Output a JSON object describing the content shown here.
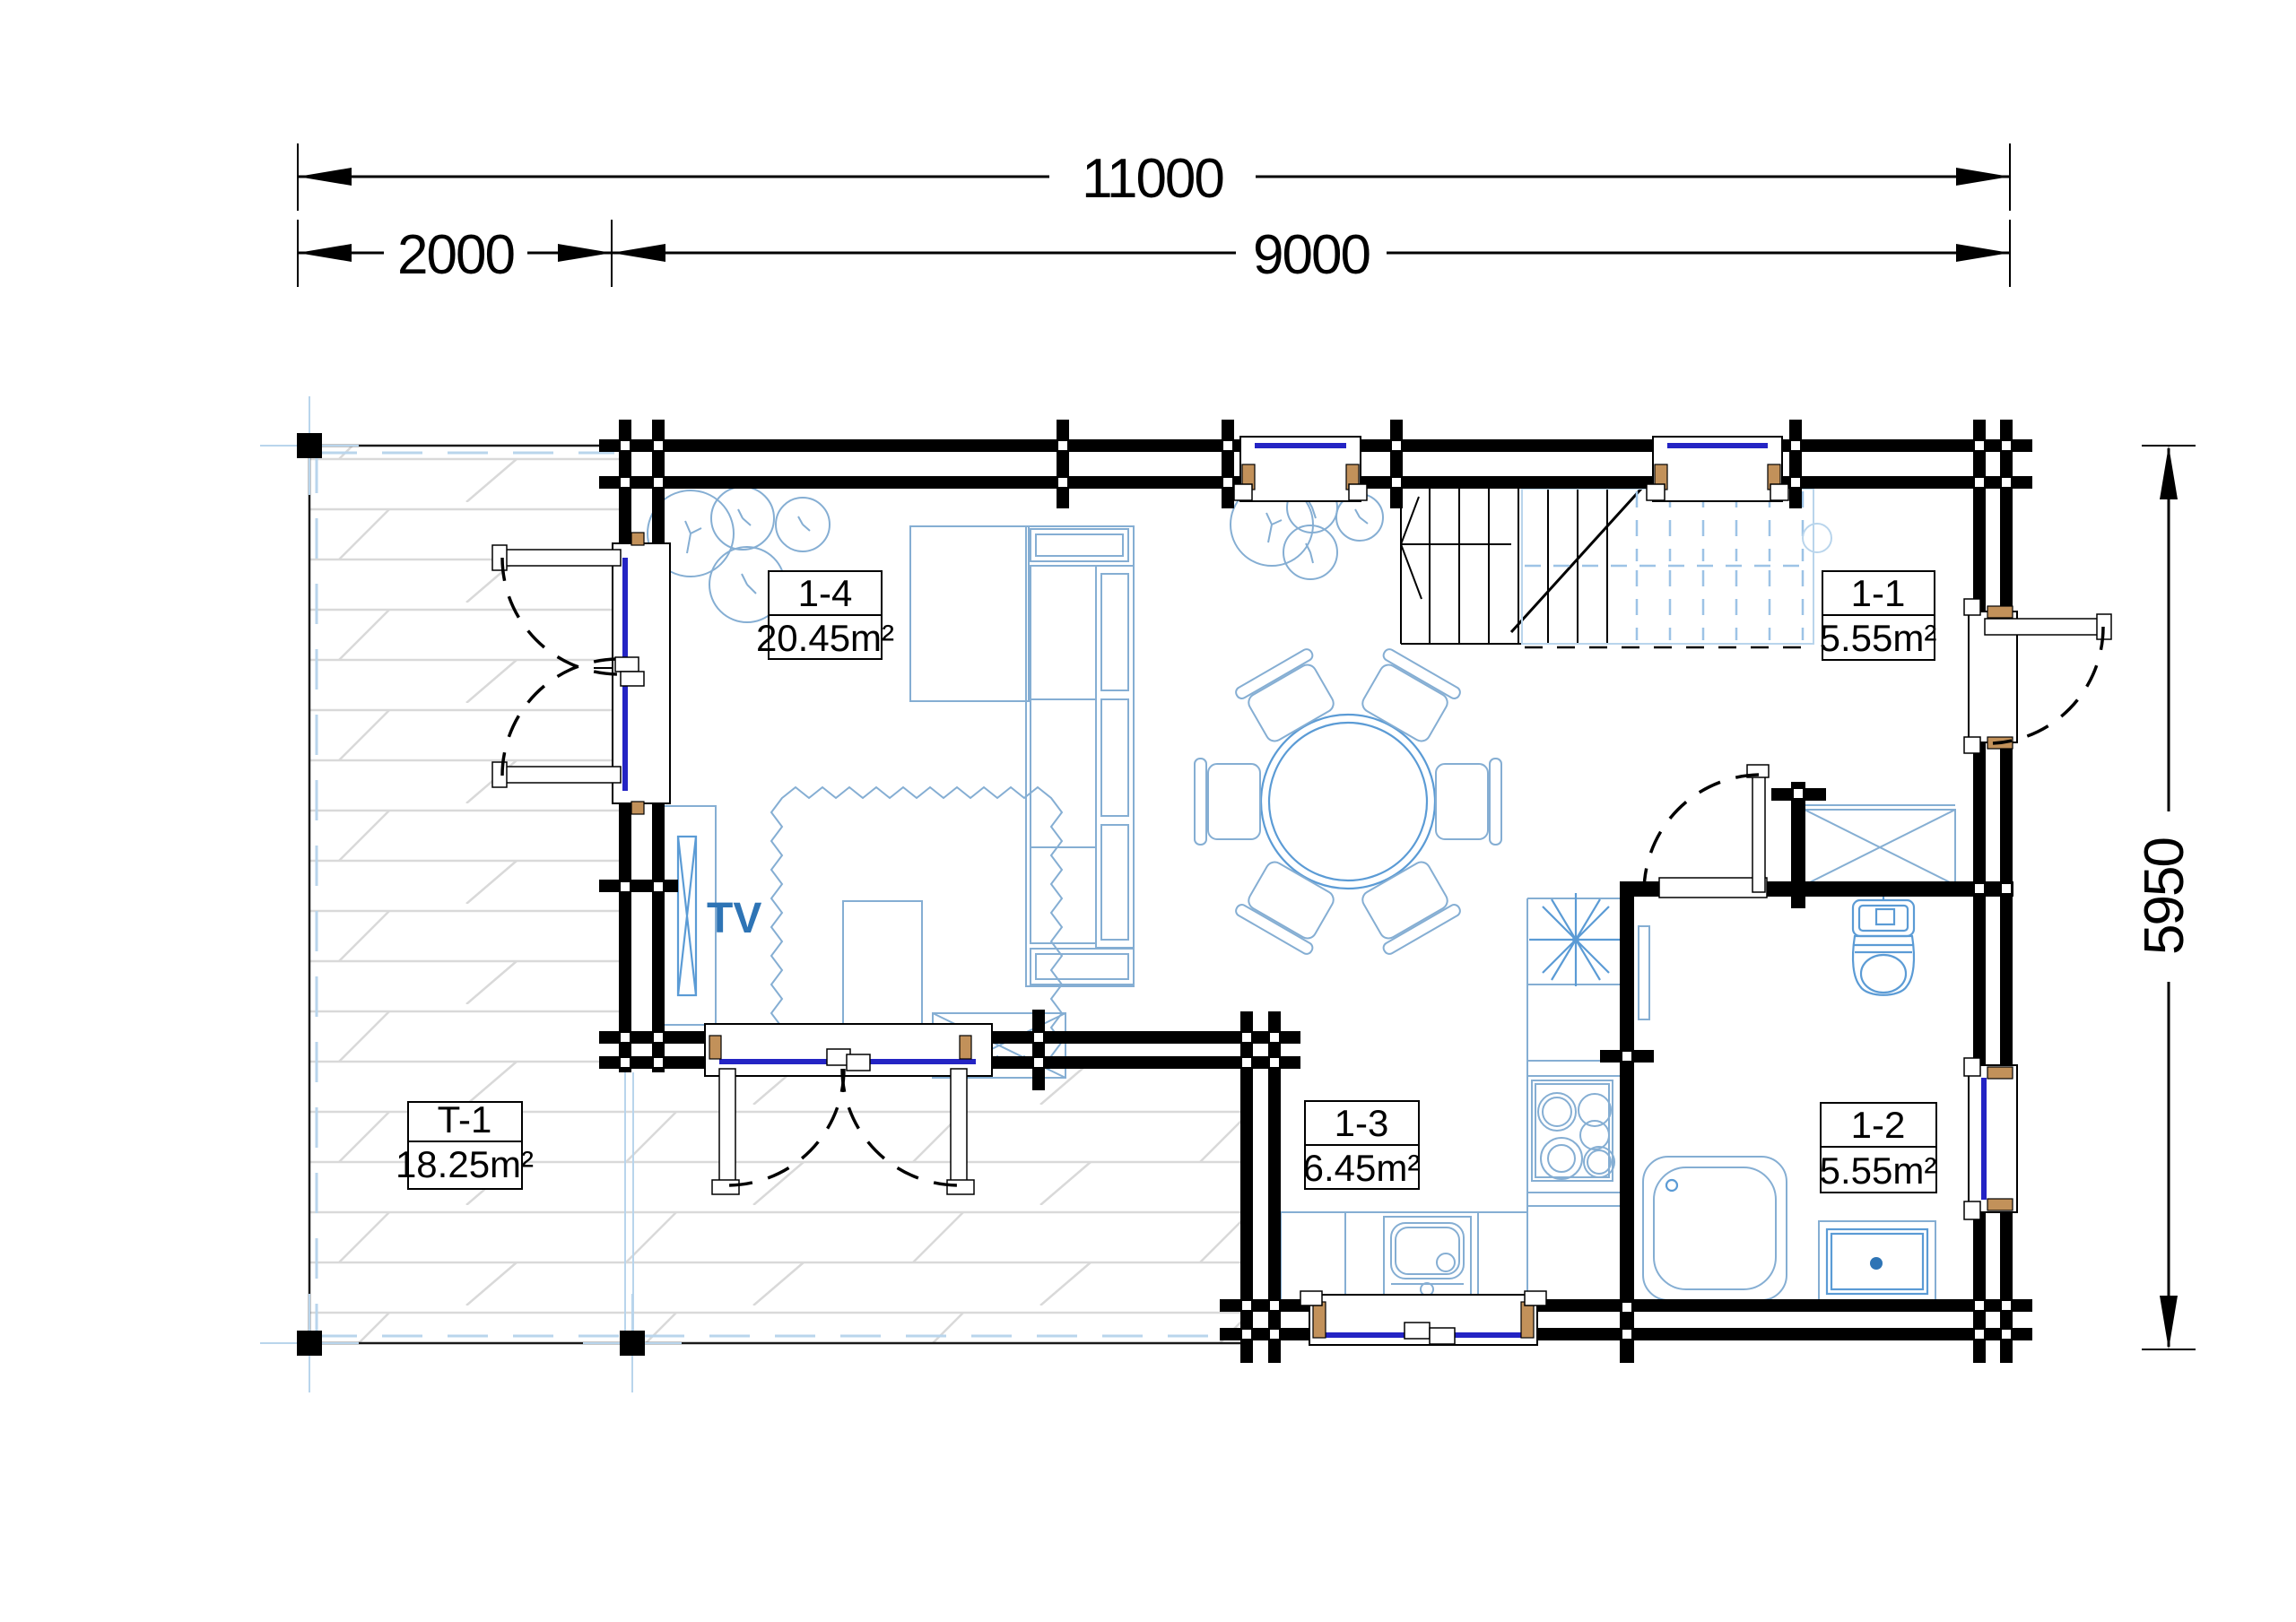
{
  "dimensions": {
    "overall_width": "11000",
    "terrace_width": "2000",
    "house_width": "9000",
    "house_depth": "5950"
  },
  "rooms": [
    {
      "id": "1-4",
      "area": "20.45m²",
      "type": "living-room"
    },
    {
      "id": "1-1",
      "area": "5.55m²",
      "type": "hall"
    },
    {
      "id": "1-3",
      "area": "6.45m²",
      "type": "kitchen"
    },
    {
      "id": "1-2",
      "area": "5.55m²",
      "type": "bathroom"
    },
    {
      "id": "T-1",
      "area": "18.25m²",
      "type": "terrace"
    }
  ],
  "annotations": {
    "tv": "TV"
  },
  "colors": {
    "wall": "#000000",
    "window_glazing": "#2424c4",
    "window_jamb_wood": "#c2915a",
    "furniture_light": "#85aed3",
    "furniture_medium": "#5b9bd5",
    "tv_label": "#2e74b5",
    "terrace_plank": "#d9d9d9",
    "terrace_railing": "#b9d5ec",
    "stair_upper_flight": "#9dc3e6"
  }
}
